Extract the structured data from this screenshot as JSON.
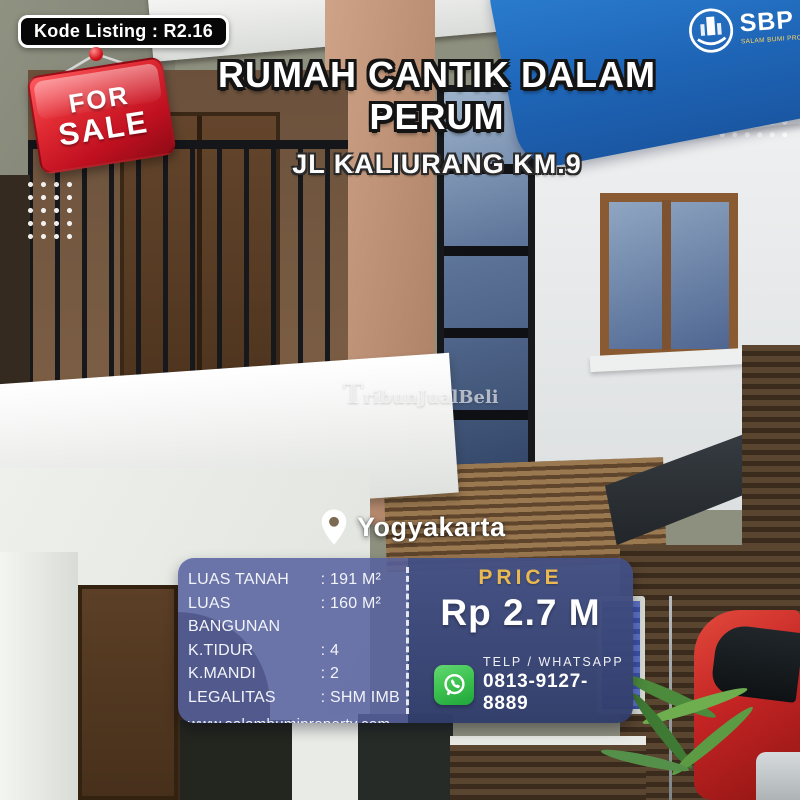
{
  "badge": {
    "text": "Kode Listing : R2.16"
  },
  "sale_tag": {
    "line1": "FOR",
    "line2": "SALE"
  },
  "title": {
    "line1": "RUMAH CANTIK DALAM",
    "line2": "PERUM",
    "address": "JL KALIURANG KM.9"
  },
  "brand": {
    "abbr": "SBP",
    "tagline": "SALAM BUMI PROPERTY"
  },
  "watermark": "TribunJualBeli",
  "location": {
    "city": "Yogyakarta"
  },
  "details": {
    "sep": ":",
    "rows": [
      {
        "label": "LUAS TANAH",
        "value": "191 M²"
      },
      {
        "label": "LUAS BANGUNAN",
        "value": "160 M²"
      },
      {
        "label": "K.TIDUR",
        "value": "4"
      },
      {
        "label": "K.MANDI",
        "value": "2"
      },
      {
        "label": "LEGALITAS",
        "value": "SHM IMB"
      }
    ],
    "website": "www.salambumiproperty.com"
  },
  "price": {
    "heading": "PRICE",
    "amount": "Rp 2.7 M",
    "contact_label": "TELP / WHATSAPP",
    "phone": "0813-9127-8889"
  },
  "colors": {
    "banner_blue": "#1f66b8",
    "sale_red": "#d21f2a",
    "panel_blue": "#56619e",
    "price_navy": "#3a477c",
    "gold": "#eab94f",
    "whatsapp_green": "#3fc351"
  }
}
